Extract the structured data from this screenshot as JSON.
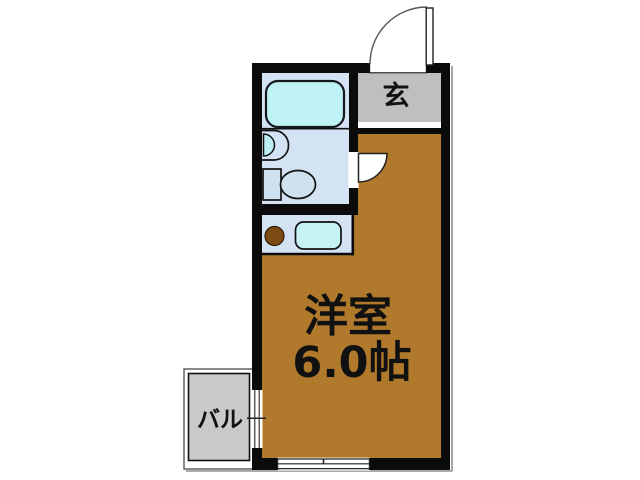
{
  "title": "floor-plan",
  "rooms": {
    "entrance": {
      "label": "玄"
    },
    "western_room": {
      "label": "洋室",
      "size": "6.0帖"
    },
    "balcony": {
      "label": "バル"
    }
  },
  "fixtures": [
    "bathtub",
    "washbasin",
    "toilet",
    "kitchen-burner",
    "kitchen-sink"
  ],
  "colors": {
    "wall": "#0b0b0b",
    "room_floor": "#B0792C",
    "wet_area_floor": "#D4E3F4",
    "bathtub": "#BEF2F4",
    "kitchen_sink": "#C6F2F4",
    "basin": "#BDEFF2",
    "fixture_fill": "#CFE0F1",
    "entrance_floor": "#BFBFBF",
    "balcony_floor": "#C9C9C9",
    "burner": "#7C4A13"
  }
}
